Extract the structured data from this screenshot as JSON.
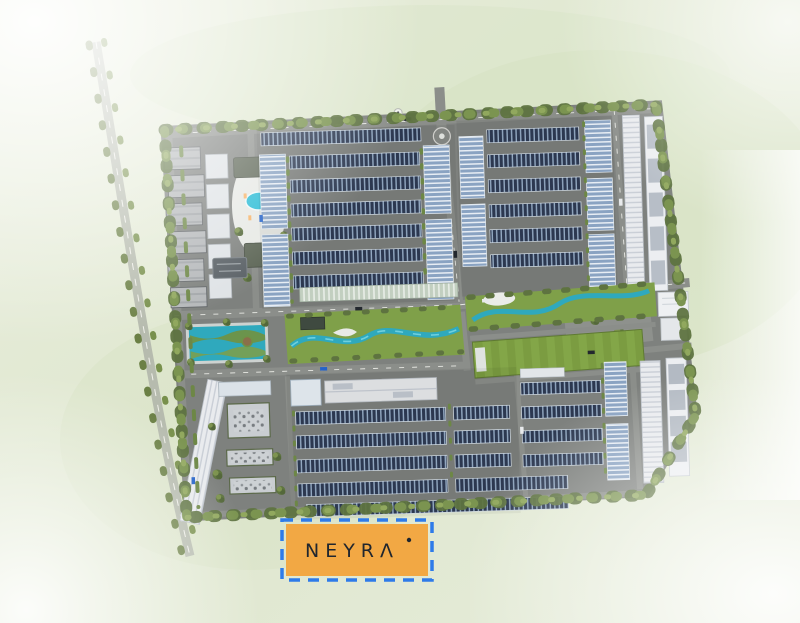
{
  "project": {
    "name": "NEYRA",
    "logo": {
      "display": "NEYRΛ",
      "accent_dot": true
    }
  },
  "badge": {
    "background": "#F2A844",
    "border_color": "#2E7BE9",
    "border_style": "dashed",
    "text_color": "#20262E"
  },
  "palette": {
    "grass": "#E3EAD6",
    "site_ground": "#7E817E",
    "road": "#8B8E8A",
    "road_marking": "#E8E9E4",
    "housing_roof_dark": "#2C3850",
    "housing_roof_light": "#8AA3C2",
    "warehouse_white": "#E9EBEE",
    "water": "#2FA9BD",
    "pool": "#29BCD6",
    "lawn": "#7FA049",
    "sports_field": "#7B9C41",
    "tree": "#5F7540"
  },
  "map": {
    "type": "residential-masterplan-aerial-render",
    "features": [
      "perimeter-tree-line",
      "external-road",
      "entrance-roundabout",
      "entrance-gate",
      "commercial-blocks",
      "clubhouse",
      "swimming-pool",
      "reflecting-pond",
      "row-housing-north",
      "row-housing-northeast",
      "row-housing-south",
      "row-housing-southeast",
      "shophouse-columns",
      "warehouses-east",
      "warehouses-southeast",
      "warehouse-central",
      "linear-park-west-water-feature",
      "linear-park-central-river",
      "linear-park-east-river",
      "sports-field",
      "central-plaza",
      "community-building",
      "utility-yard",
      "garden-row"
    ]
  }
}
